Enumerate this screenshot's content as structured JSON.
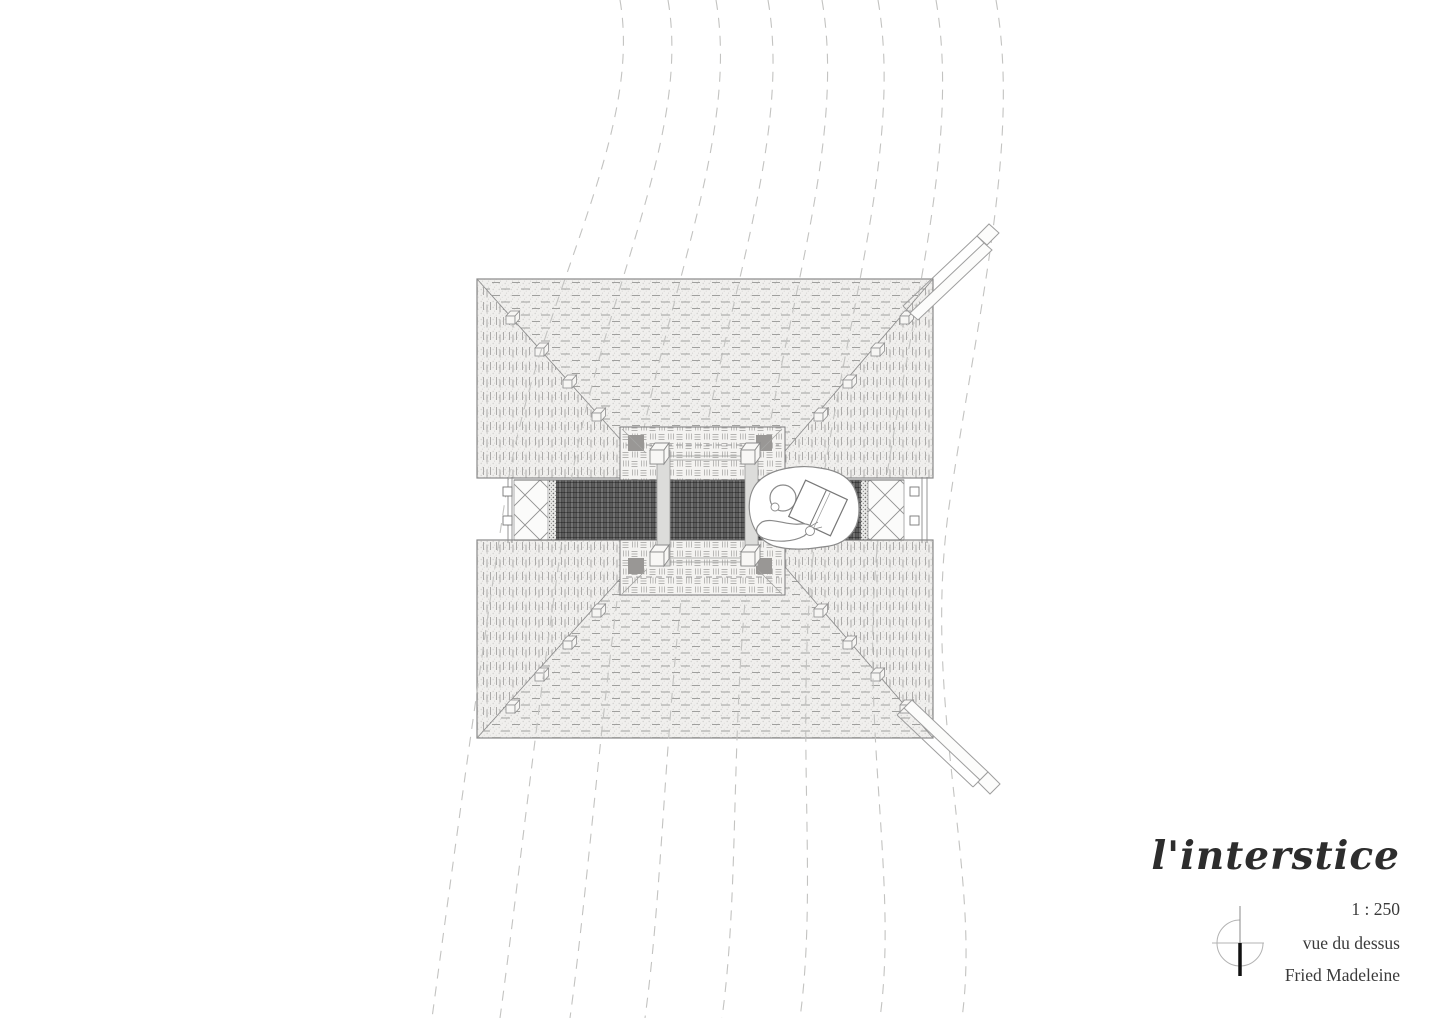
{
  "title_block": {
    "project_title": "l'interstice",
    "scale": "1 : 250",
    "view_label": "vue du dessus",
    "author": "Fried Madeleine"
  },
  "icons": {
    "north_arrow": "north-arrow-icon"
  },
  "colors": {
    "paper": "#ffffff",
    "ink": "#3a3a3a",
    "flow_line": "#c3c3c1",
    "plan_line": "#9a9a9a",
    "block_fill": "#f0efed",
    "dark_band": "#4e4e4e"
  },
  "plan": {
    "parts": [
      "upper canopy block",
      "lower canopy block",
      "central gallery band",
      "lattice screens",
      "courtyard frame",
      "column posts",
      "reading figure",
      "northeast walkway beam",
      "southeast walkway beam",
      "wind flow lines"
    ]
  }
}
